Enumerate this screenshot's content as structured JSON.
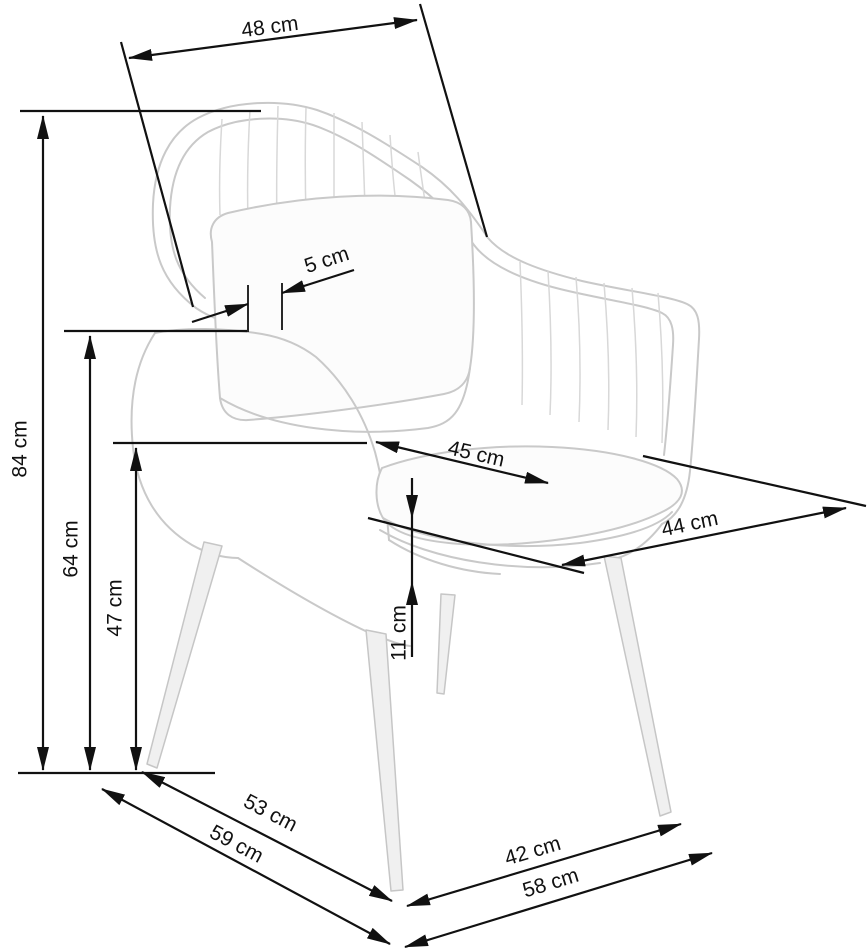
{
  "figure": {
    "subject": "armchair dimension diagram",
    "unit": "cm"
  },
  "dimensions": {
    "d48": {
      "label": "48 cm",
      "value": 48,
      "unit": "cm"
    },
    "d84": {
      "label": "84 cm",
      "value": 84,
      "unit": "cm"
    },
    "d64": {
      "label": "64 cm",
      "value": 64,
      "unit": "cm"
    },
    "d47": {
      "label": "47 cm",
      "value": 47,
      "unit": "cm"
    },
    "d5": {
      "label": "5 cm",
      "value": 5,
      "unit": "cm"
    },
    "d45": {
      "label": "45 cm",
      "value": 45,
      "unit": "cm"
    },
    "d44": {
      "label": "44 cm",
      "value": 44,
      "unit": "cm"
    },
    "d11": {
      "label": "11 cm",
      "value": 11,
      "unit": "cm"
    },
    "d53": {
      "label": "53 cm",
      "value": 53,
      "unit": "cm"
    },
    "d59": {
      "label": "59 cm",
      "value": 59,
      "unit": "cm"
    },
    "d42": {
      "label": "42 cm",
      "value": 42,
      "unit": "cm"
    },
    "d58": {
      "label": "58 cm",
      "value": 58,
      "unit": "cm"
    }
  },
  "style": {
    "dimension_color": "#111111",
    "sketch_color": "#c9c9c9",
    "background": "#ffffff"
  }
}
